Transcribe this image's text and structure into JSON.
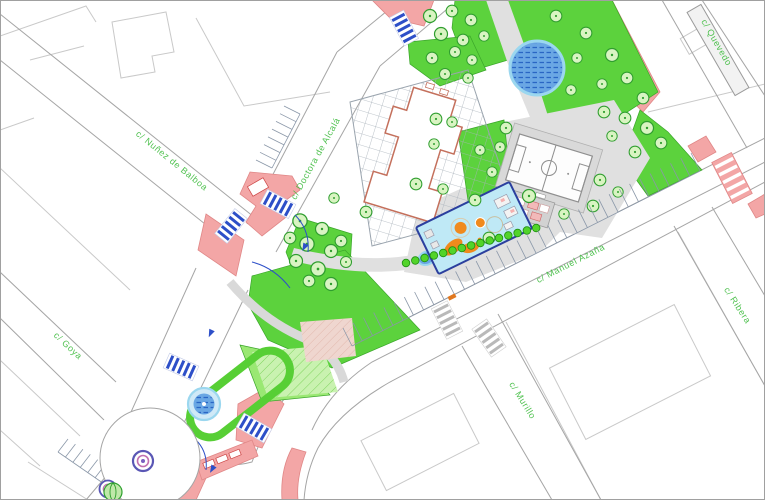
{
  "map": {
    "type": "urban-site-plan",
    "street_labels": {
      "nunez": "c/ Nuñez de Balboa",
      "doctora": "c/ Doctora de Alcalá",
      "quevedo": "c/ Quevedo",
      "ribera": "c/ Ribera",
      "murillo": "c/ Murillo",
      "goya": "c/ Goya",
      "azana": "c/ Manuel Azaña"
    },
    "features": [
      "pond",
      "fountain",
      "playground",
      "sports-court",
      "plaza-grid-building",
      "roundabout",
      "lawns",
      "tree-rows",
      "parking-stalls",
      "pedestrian-crossings",
      "loading-bays"
    ],
    "colors": {
      "label_green": "#3dbb3d",
      "lawn_green": "#5cd23d",
      "lawn_light": "#c9f2b0",
      "paving_pink": "#f3a6a6",
      "paving_pink_edge": "#e08787",
      "water_blue": "#6aa7e4",
      "water_hatch": "#2a66c4",
      "water_ring": "#9bd7ef",
      "playground_fill": "#bfe9f6",
      "playground_border": "#2b3f9e",
      "equipment_orange": "#f08a1d",
      "path_gray": "#e0e0e0",
      "street_edge_gray": "#a5a5a5",
      "parcel_gray": "#c9c9c9",
      "building_outline_red": "#c4705c",
      "marking_blue": "#2d4fc8",
      "ring_purple": "#5a57b5",
      "ring_magenta": "#c06fb0"
    }
  }
}
